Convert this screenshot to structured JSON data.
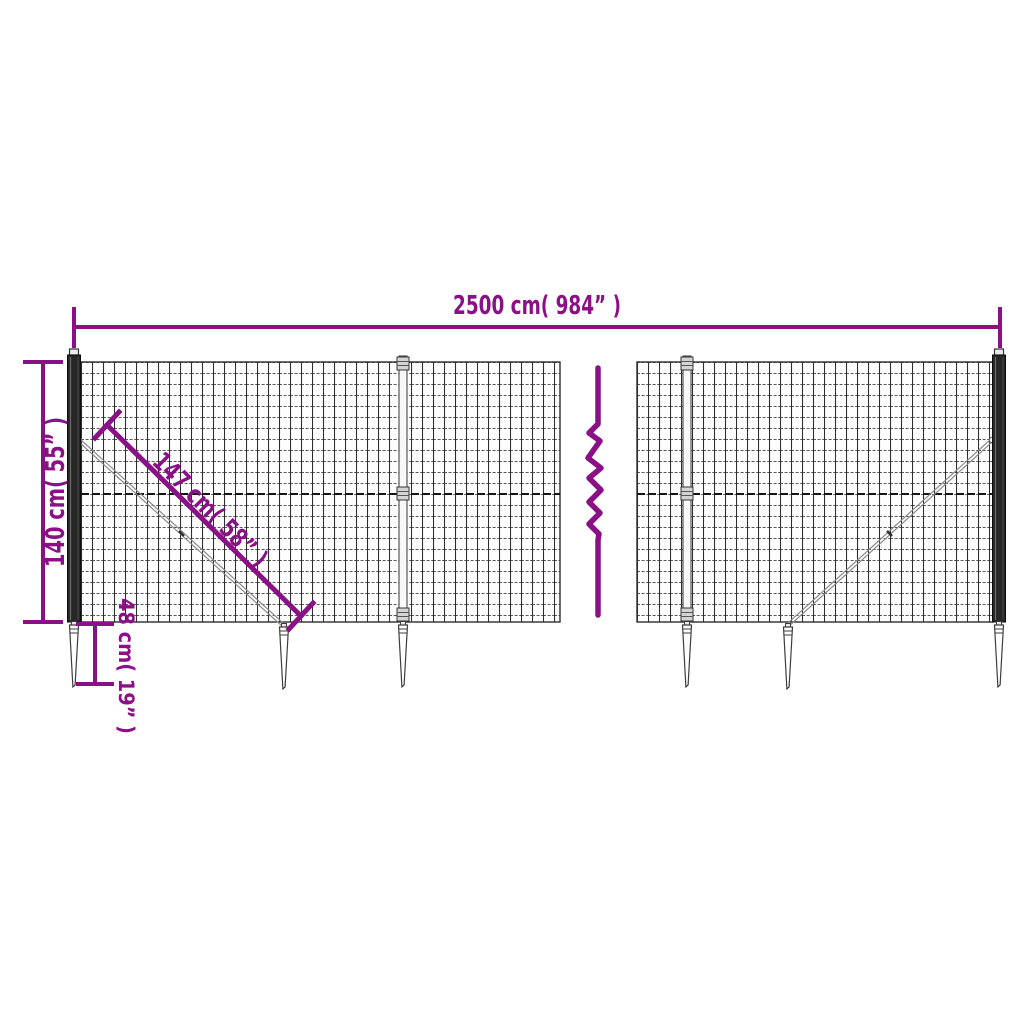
{
  "diagram": {
    "dimensions": {
      "total_width": "2500 cm( 984”  )",
      "fence_height": "140 cm( 55”  )",
      "brace_length": "147 cm( 58”  )",
      "spike_depth": "48 cm( 19”  )"
    },
    "colors": {
      "dimension": "#8a1086",
      "mesh": "#2e2e2e",
      "background": "#ffffff"
    }
  }
}
